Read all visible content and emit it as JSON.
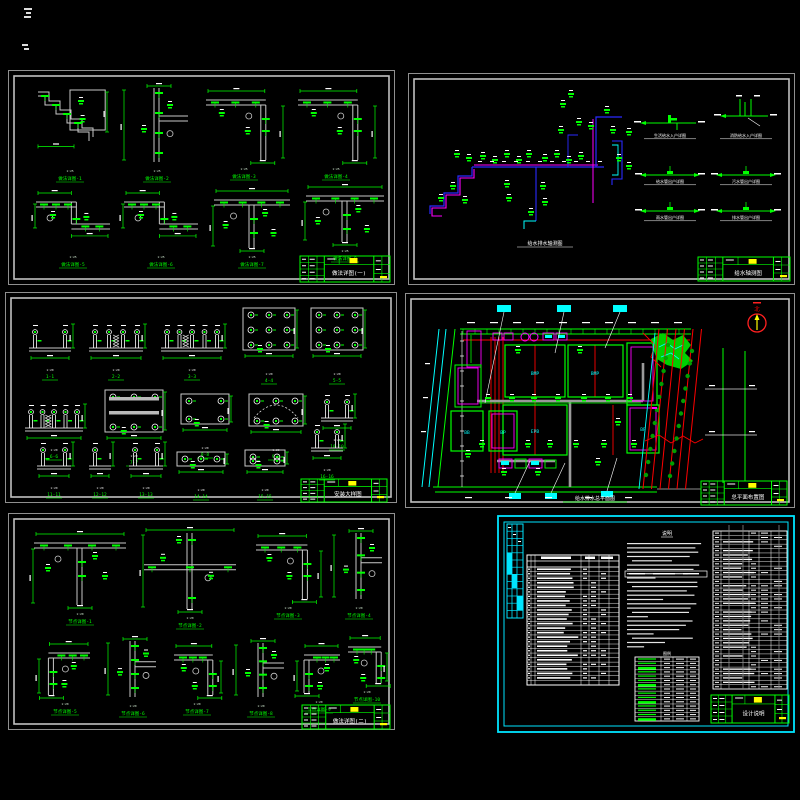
{
  "colors": {
    "bg": "#000000",
    "frame_outer": "#8f8f8f",
    "frame_inner": "#c0c0c0",
    "green": "#00ff00",
    "white": "#ffffff",
    "gray_line": "#c9c9c9",
    "blue": "#2a2aff",
    "magenta": "#ff00ff",
    "cyan": "#00ffff",
    "red": "#ff0000",
    "yellow": "#ffff00",
    "tree_green": "#00a000",
    "road_gray": "#9a9a9a"
  },
  "sheets": [
    {
      "name": "structural-details-1",
      "title_block": "做法详图(一)",
      "details": [
        {
          "note": "1:25",
          "label": "做法详图-1"
        },
        {
          "note": "1:25",
          "label": "做法详图-2"
        },
        {
          "note": "1:25",
          "label": "做法详图-3"
        },
        {
          "note": "1:25",
          "label": "做法详图-4"
        },
        {
          "note": "1:25",
          "label": "做法详图-5"
        },
        {
          "note": "1:25",
          "label": "做法详图-6"
        },
        {
          "note": "1:25",
          "label": "做法详图-7"
        },
        {
          "note": "1:25",
          "label": "做法详图-8"
        }
      ]
    },
    {
      "name": "pipe-axonometric",
      "title_block": "给水轴测图",
      "caption": "给水排水轴测图",
      "minis": [
        {
          "label": "生活给水入户详图"
        },
        {
          "label": "消防给水入户详图"
        },
        {
          "label": "给水管出户详图"
        },
        {
          "label": "污水管出户详图"
        },
        {
          "label": "雨水管出户详图"
        },
        {
          "label": "排水管出户详图"
        }
      ]
    },
    {
      "name": "fixture-details",
      "title_block": "安装大样图",
      "details": [
        {
          "note": "1:20",
          "label": "1-1"
        },
        {
          "note": "1:20",
          "label": "2-2"
        },
        {
          "note": "1:20",
          "label": "3-3"
        },
        {
          "note": "1:20",
          "label": "4-4"
        },
        {
          "note": "1:20",
          "label": "5-5"
        },
        {
          "note": "1:20",
          "label": "6-6"
        },
        {
          "note": "1:20",
          "label": "7-7"
        },
        {
          "note": "1:20",
          "label": "8-8"
        },
        {
          "note": "1:20",
          "label": "9-9"
        },
        {
          "note": "1:20",
          "label": "10-10"
        },
        {
          "note": "1:20",
          "label": "11-11"
        },
        {
          "note": "1:20",
          "label": "12-12"
        },
        {
          "note": "1:20",
          "label": "13-13"
        },
        {
          "note": "1:20",
          "label": "14-14"
        },
        {
          "note": "1:20",
          "label": "15-15"
        },
        {
          "note": "1:20",
          "label": "16-16"
        }
      ]
    },
    {
      "name": "site-plan",
      "title_block": "总平面布置图",
      "caption": "给水排水总平面图",
      "north_label": "北",
      "buildings": [
        "BMP",
        "BMP",
        "EPB",
        "BB",
        "BP",
        "BP"
      ]
    },
    {
      "name": "structural-details-2",
      "title_block": "做法详图(二)",
      "details": [
        {
          "note": "1:20",
          "label": "节点详图-1"
        },
        {
          "note": "1:20",
          "label": "节点详图-2"
        },
        {
          "note": "1:20",
          "label": "节点详图-3"
        },
        {
          "note": "1:20",
          "label": "节点详图-4"
        },
        {
          "note": "1:20",
          "label": "节点详图-5"
        },
        {
          "note": "1:20",
          "label": "节点详图-6"
        },
        {
          "note": "1:20",
          "label": "节点详图-7"
        },
        {
          "note": "1:20",
          "label": "节点详图-8"
        },
        {
          "note": "1:20",
          "label": "节点详图-9"
        },
        {
          "note": "1:20",
          "label": "节点详图-10"
        }
      ]
    },
    {
      "name": "design-notes",
      "title_block": "设计说明",
      "notes_title": "说明",
      "legend_title": "图例"
    }
  ]
}
